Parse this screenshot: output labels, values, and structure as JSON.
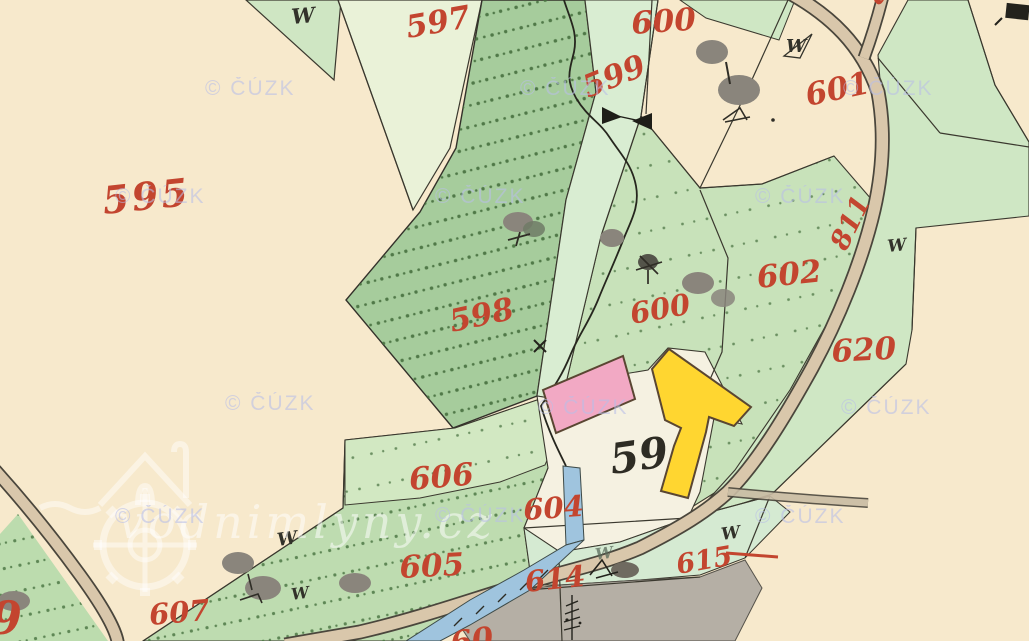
{
  "map": {
    "description": "Historical hand-drawn cadastral map sheet (imperial stable cadastre style)",
    "labels": {
      "p595": "595",
      "p597": "597",
      "p598": "598",
      "p599": "599",
      "p600_top": "600",
      "p600_mid": "600",
      "p601": "601",
      "p602": "602",
      "p604": "604",
      "p605": "605",
      "p606": "606",
      "p607": "607",
      "p614": "614",
      "p615": "615",
      "p620": "620",
      "road_811": "811",
      "house_59": "59",
      "partial_left": "9",
      "partial_bottom": "60",
      "partial_top": "81"
    },
    "symbols": {
      "meadow": "W"
    },
    "watermarks": {
      "cuzk": "© ČÚZK",
      "site": "vodnimlyny.cz"
    },
    "colors": {
      "field_cream": "#f7e9cc",
      "meadow_light": "#d9edd2",
      "meadow_mid": "#c8e2ba",
      "forest_green": "#a6cc9c",
      "parcel_pale": "#eaf2d8",
      "road_tan": "#d9c7ab",
      "water_blue": "#9fc4de",
      "building_pink": "#f2a9c4",
      "building_yellow": "#ffd630",
      "pond_gray": "#b5afa5",
      "label_red": "#c3452f",
      "ink_black": "#2e2c24"
    }
  }
}
